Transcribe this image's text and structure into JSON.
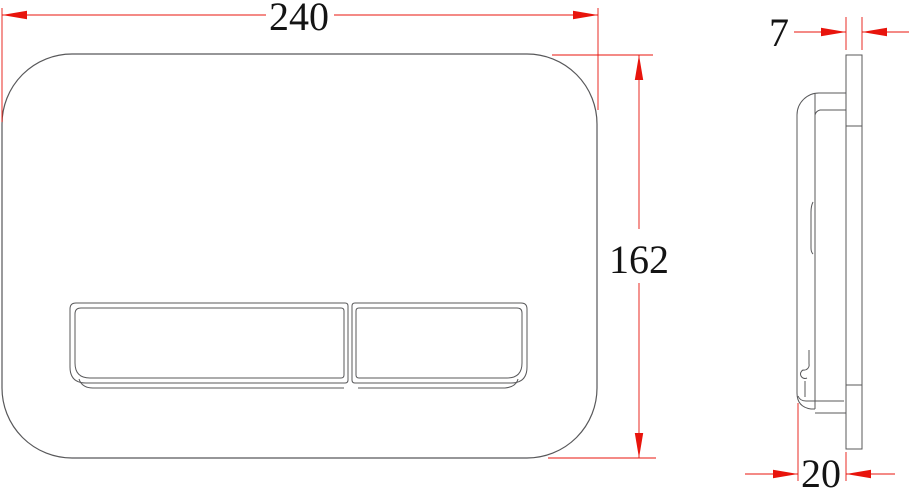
{
  "dims": {
    "width": "240",
    "height": "162",
    "thickness": "7",
    "depth": "20"
  },
  "colors": {
    "dimension": "#e8140c",
    "line": "#58585a",
    "text": "#141414",
    "background": "#ffffff"
  }
}
